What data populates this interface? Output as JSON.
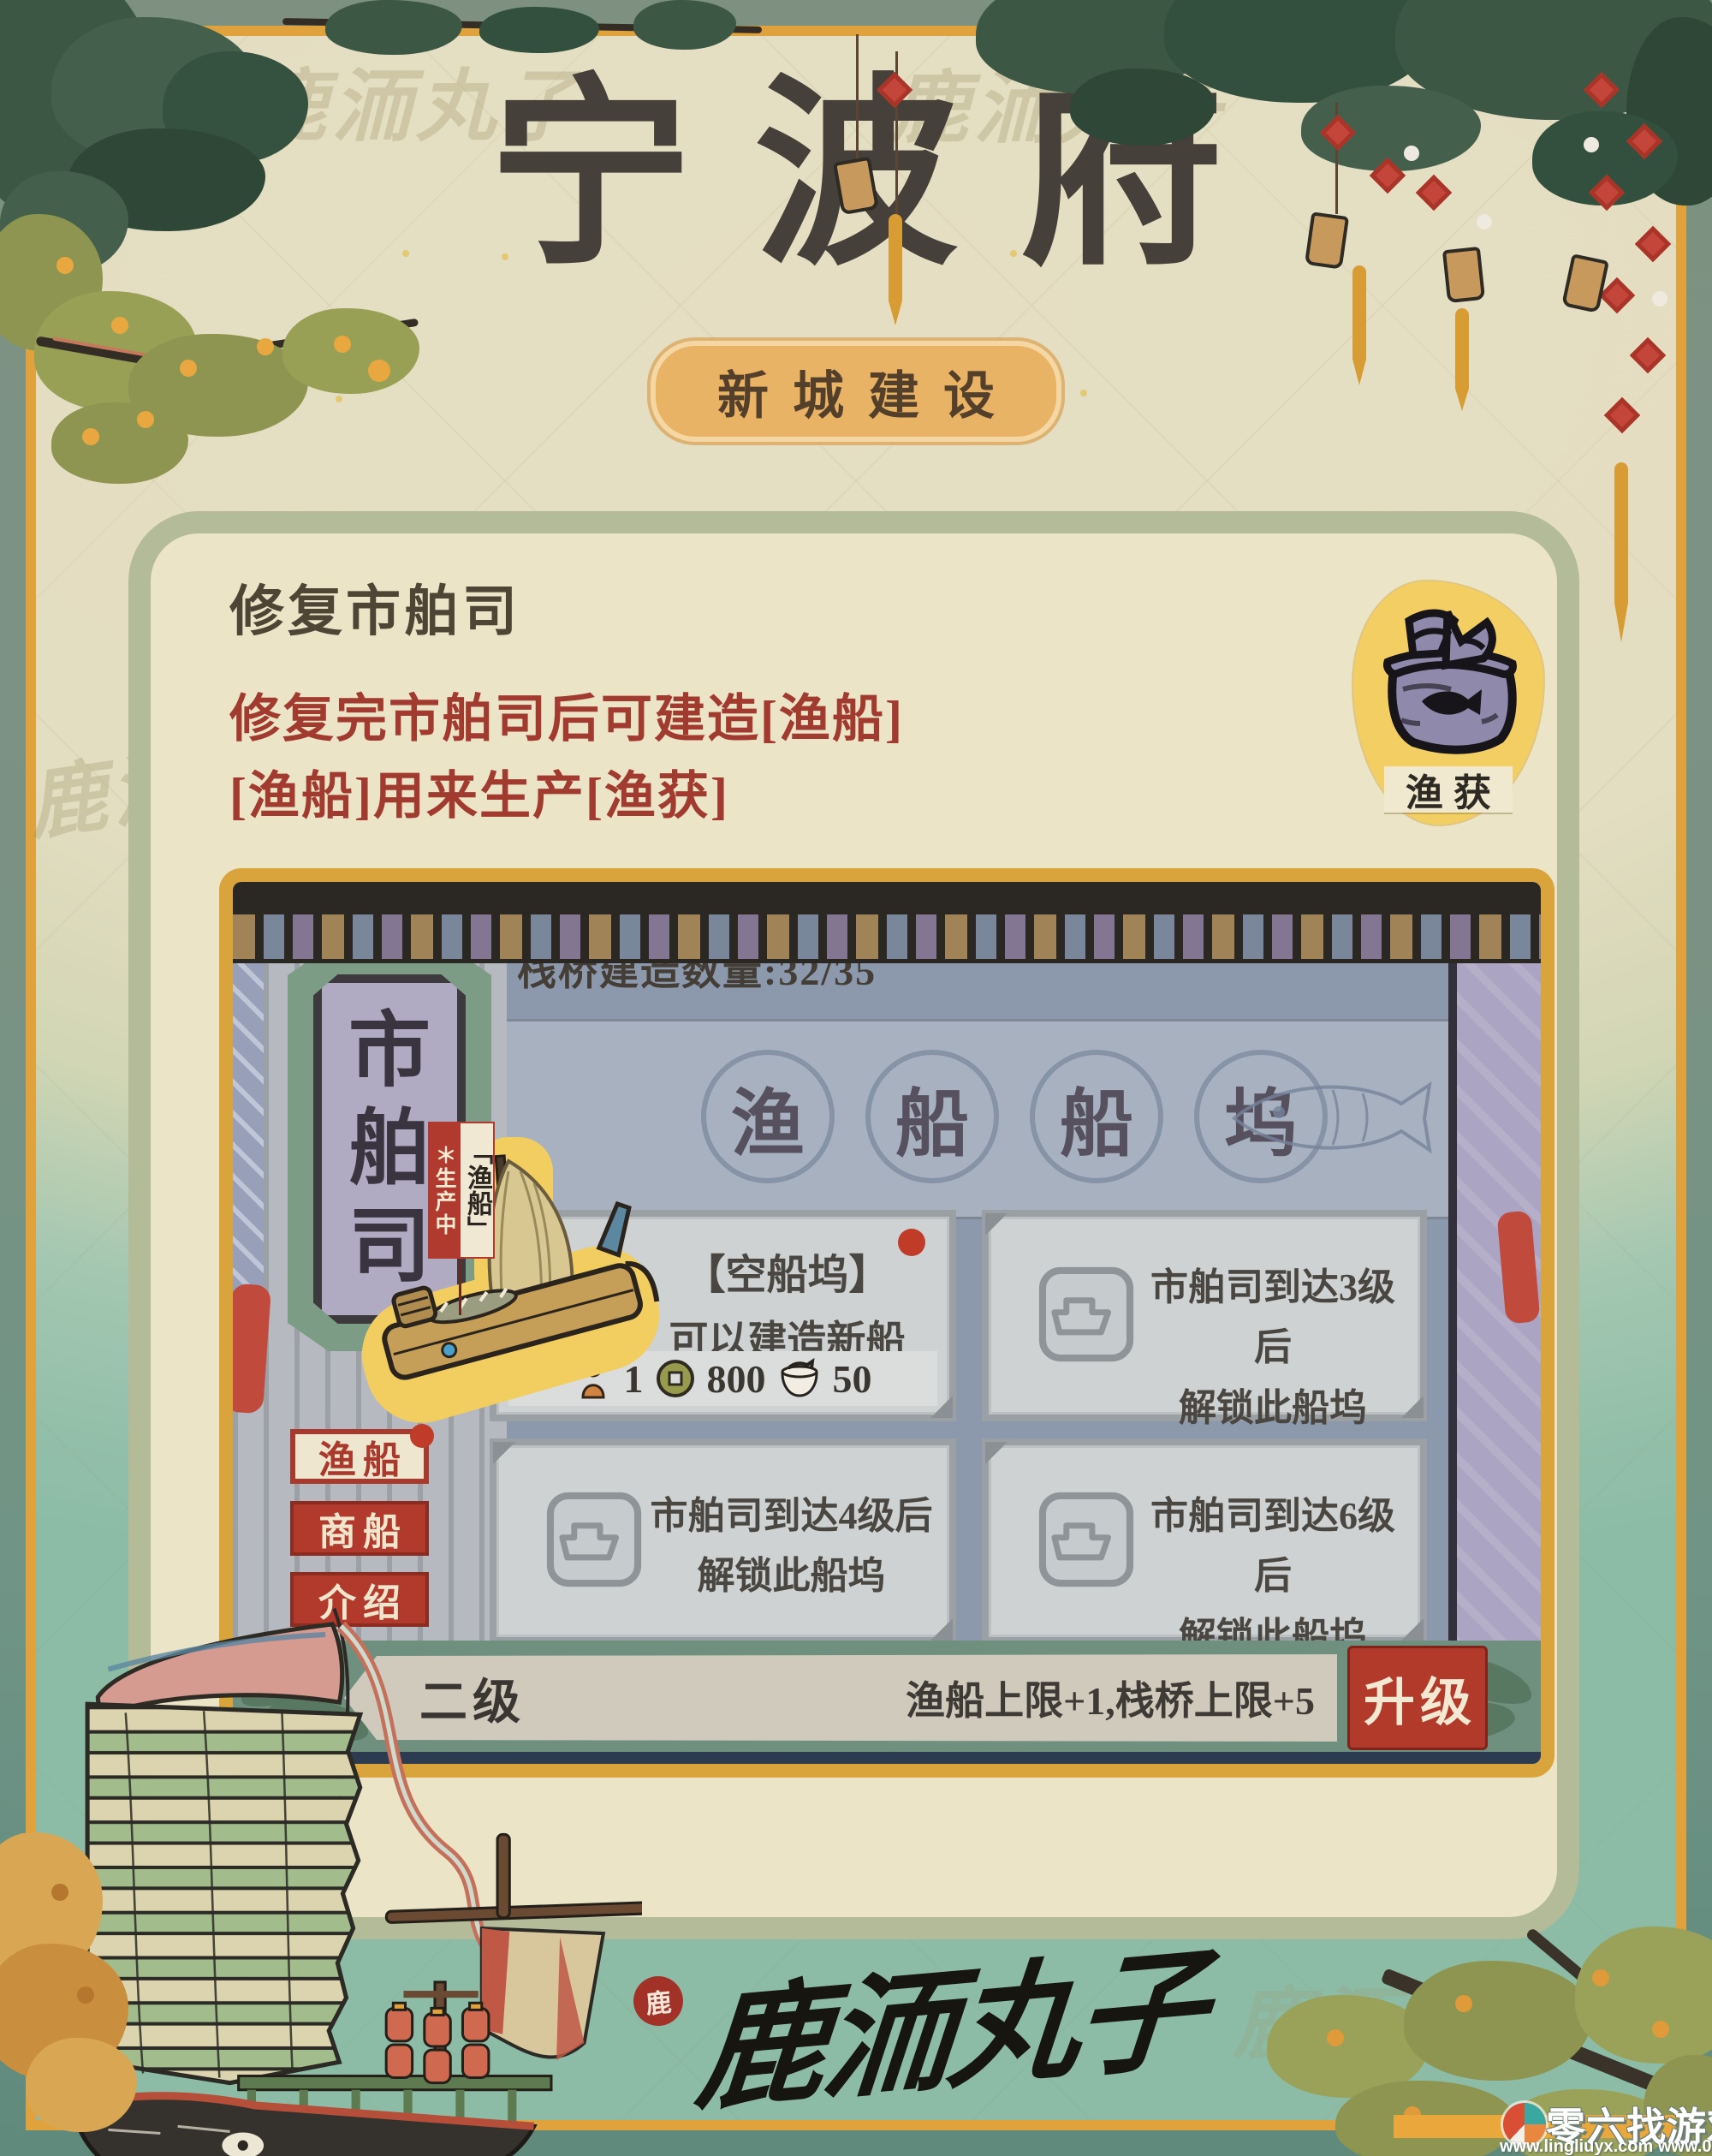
{
  "poster": {
    "title": "宁波府",
    "badge": "新城建设",
    "watermark": "鹿洏丸子"
  },
  "tip": {
    "heading": "修复市舶司",
    "line1": "修复完市舶司后可建造[渔船]",
    "line2": "[渔船]用来生产[渔获]",
    "resource_label": "渔获"
  },
  "game": {
    "plaque_chars": [
      "市",
      "舶",
      "司"
    ],
    "pier_counter": "栈桥建造数量:32/35",
    "dock_title_chars": [
      "渔",
      "船",
      "船",
      "坞"
    ],
    "boat": {
      "status": "＊生产中",
      "name": "「渔船」"
    },
    "slots": [
      {
        "title": "【空船坞】",
        "desc": "可以建造新船",
        "costs": [
          {
            "icon": "worker-icon",
            "value": "1"
          },
          {
            "icon": "coin-icon",
            "value": "800"
          },
          {
            "icon": "bowl-icon",
            "value": "50"
          }
        ]
      },
      {
        "line1": "市舶司到达3级后",
        "line2": "解锁此船坞"
      },
      {
        "line1": "市舶司到达4级后",
        "line2": "解锁此船坞"
      },
      {
        "line1": "市舶司到达6级后",
        "line2": "解锁此船坞"
      }
    ],
    "tabs": [
      {
        "label": "渔船"
      },
      {
        "label": "商船"
      },
      {
        "label": "介绍"
      }
    ],
    "level_bar": {
      "level": "二级",
      "effect": "渔船上限+1,栈桥上限+5",
      "upgrade_label": "升级"
    }
  },
  "footer": {
    "seal": "鹿",
    "signature": "鹿洏丸子",
    "promo_brand": "零六找游戏",
    "promo_urls": "www.lingliuyx.com   www.06zyx.com"
  },
  "colors": {
    "accent_red": "#b23a2c",
    "gold_frame": "#d9a43c",
    "teal_bg": "#93bfa9",
    "panel_blue": "#8c99ad",
    "badge_orange": "#e9b366"
  }
}
